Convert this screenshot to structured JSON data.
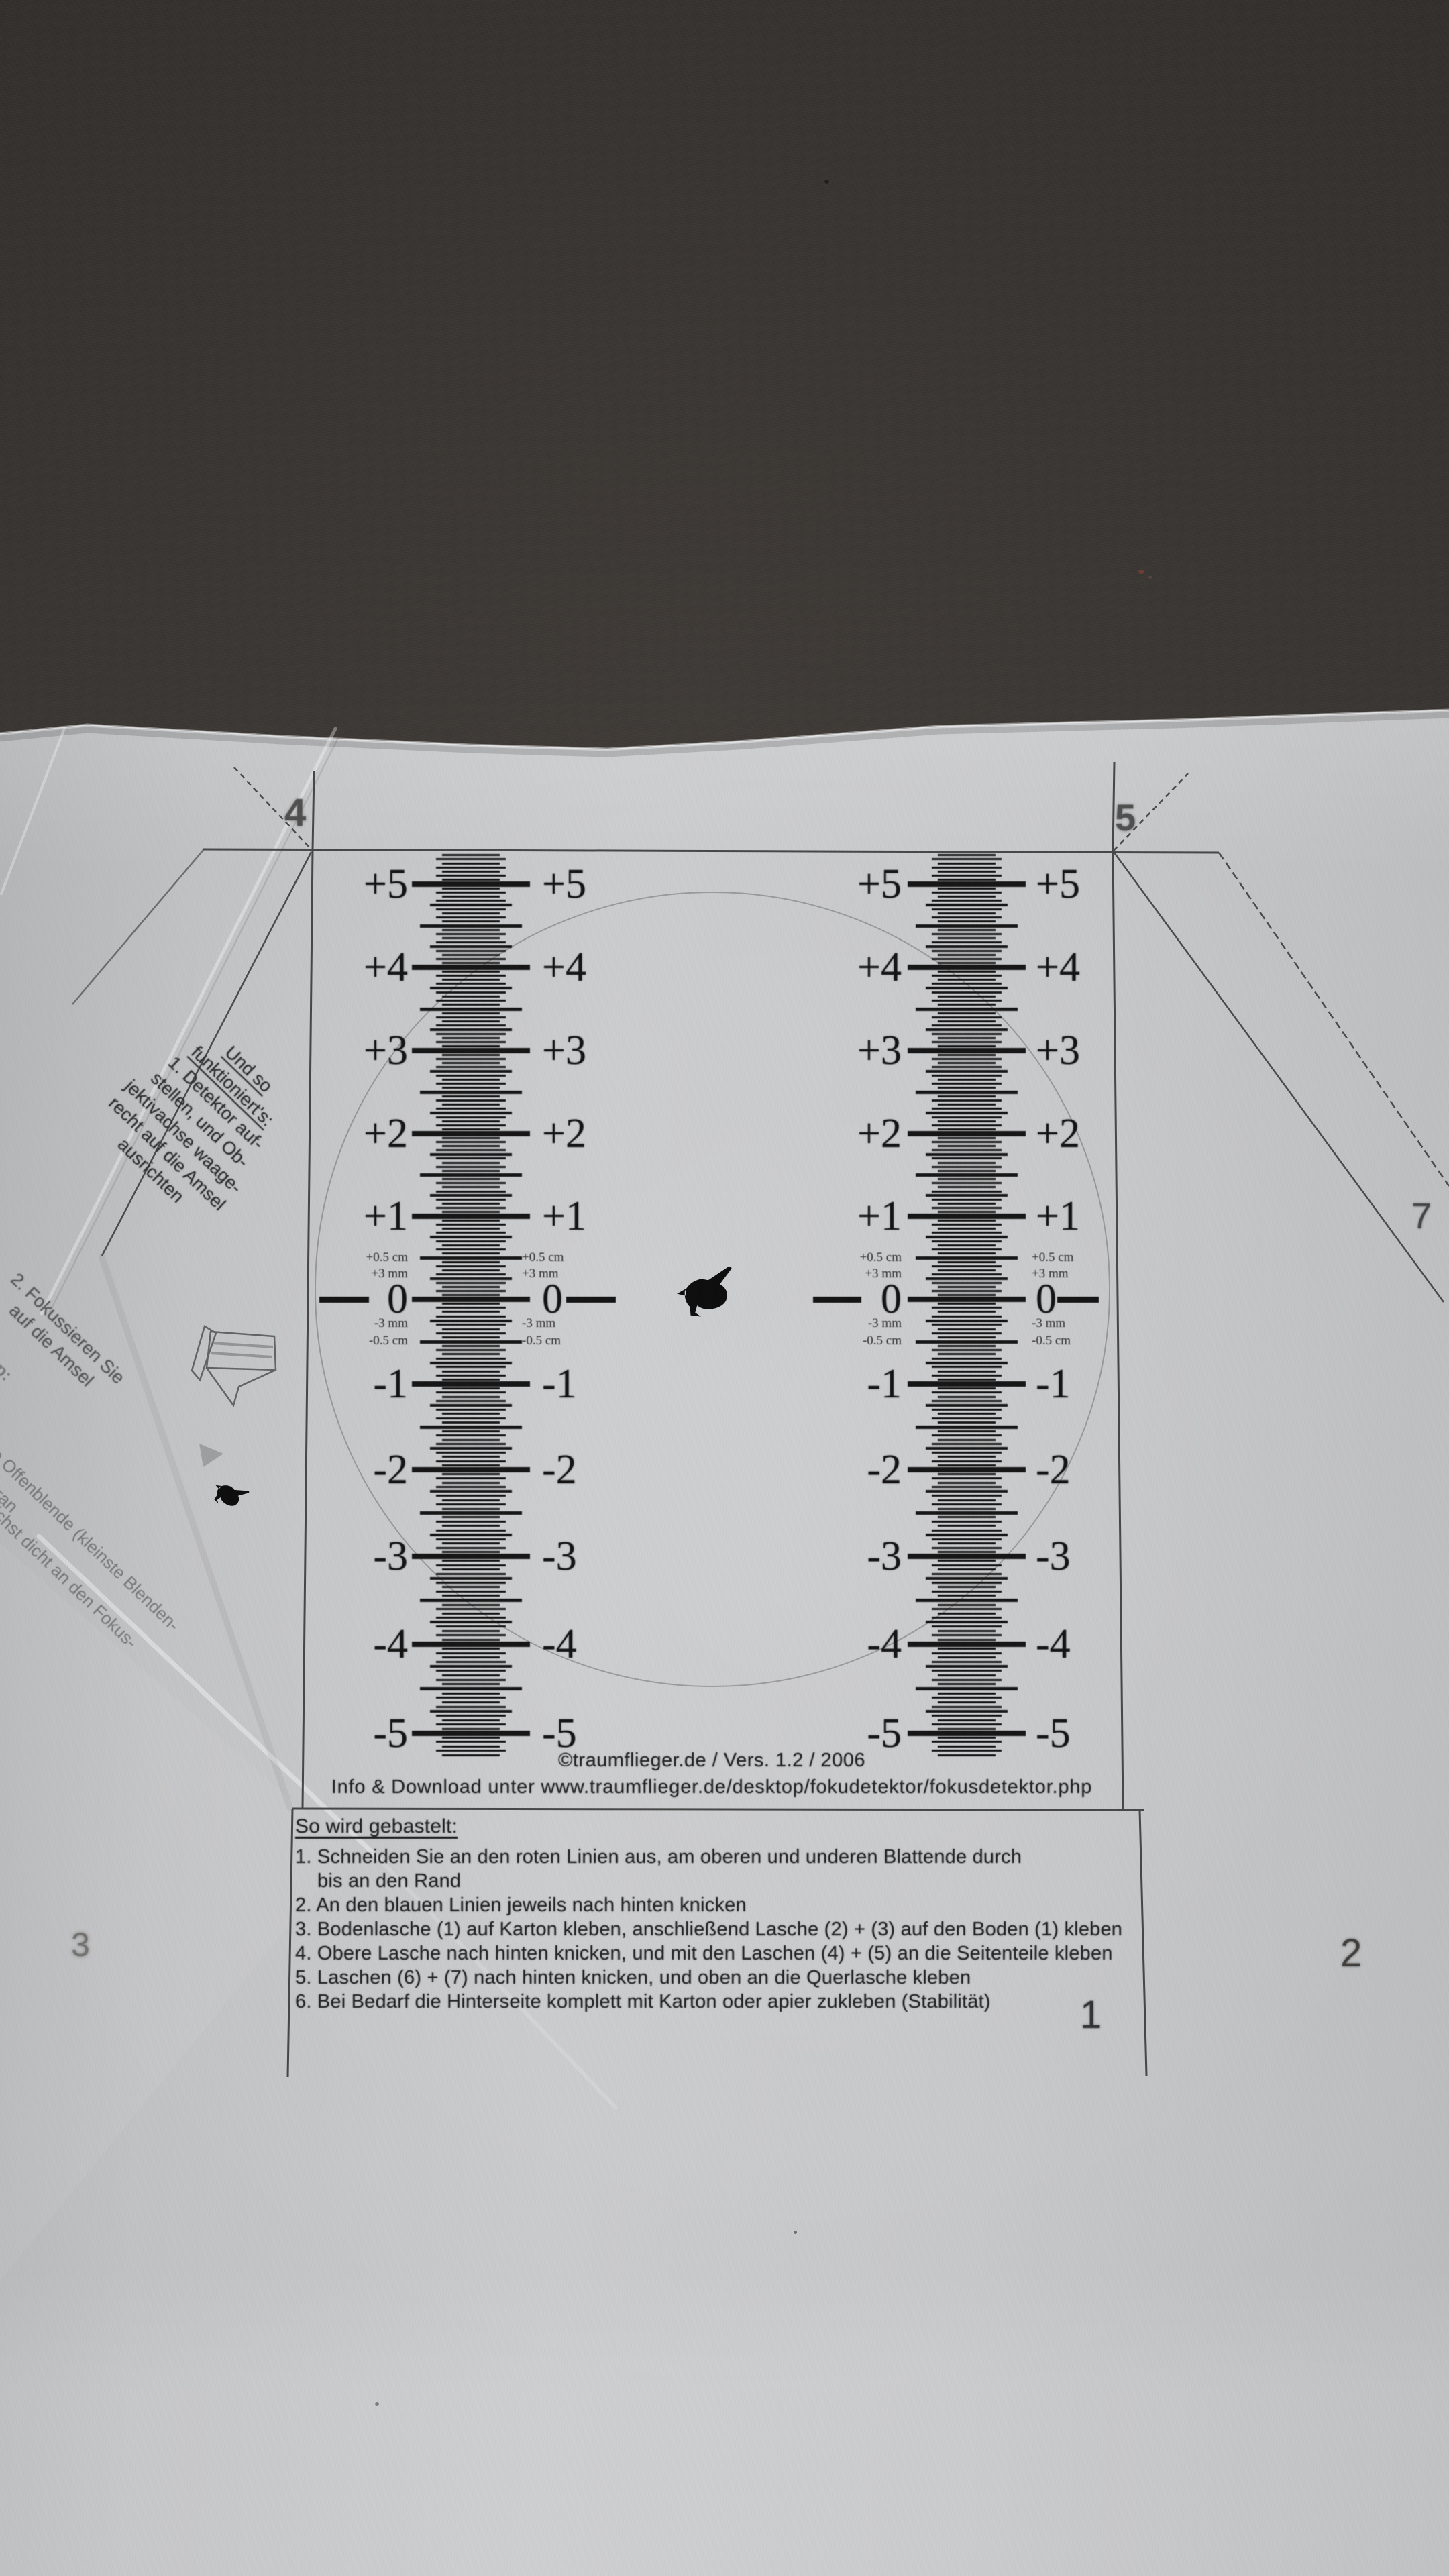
{
  "colors": {
    "backdrop": "#393532",
    "paper": "#c6c7c9",
    "ink": "#222222"
  },
  "template": {
    "corner_markers": {
      "top_left": "4",
      "top_right": "5",
      "right_side": "7",
      "bottom_left": "3",
      "bottom_right": "2",
      "bottom_inner": "1"
    },
    "scale": {
      "major_labels": [
        "+5",
        "+4",
        "+3",
        "+2",
        "+1",
        "0",
        "-1",
        "-2",
        "-3",
        "-4",
        "-5"
      ],
      "fine_labels": [
        "+0.5 cm",
        "+3 mm",
        "-3 mm",
        "-0.5 cm"
      ],
      "columns": 2
    },
    "side_note": {
      "heading_lines": [
        "Und so",
        "funktioniert's:"
      ],
      "body_lines": [
        "1. Detektor auf-",
        "stellen, und Ob-",
        "jektivachse waage-",
        "recht auf die Amsel",
        "ausrichten"
      ]
    },
    "side_note_2": {
      "lines": [
        "2. Fokussieren Sie",
        "auf die Amsel"
      ]
    },
    "side_tip": {
      "label": "Tipp:",
      "fragments": [
        "n Sie die Offenblende (kleinste Blenden-",
        "d gehen möglichst dicht an den Fokus-",
        "heran"
      ]
    },
    "footer": {
      "copyright": "©traumflieger.de / Vers. 1.2 / 2006",
      "info": "Info & Download unter www.traumflieger.de/desktop/fokudetektor/fokusdetektor.php"
    },
    "instructions": {
      "heading": "So wird gebastelt:",
      "items": [
        "1. Schneiden Sie an den roten Linien aus, am oberen und underen Blattende durch",
        "    bis an den Rand",
        "2. An den blauen Linien jeweils nach hinten knicken",
        "3. Bodenlasche (1) auf Karton kleben, anschließend Lasche (2) + (3) auf den Boden (1) kleben",
        "4. Obere Lasche nach hinten knicken, und mit den Laschen (4) + (5) an die Seitenteile kleben",
        "5. Laschen (6) + (7) nach hinten knicken, und oben an die Querlasche kleben",
        "6. Bei Bedarf die Hinterseite komplett mit Karton oder apier zukleben (Stabilität)"
      ]
    }
  }
}
